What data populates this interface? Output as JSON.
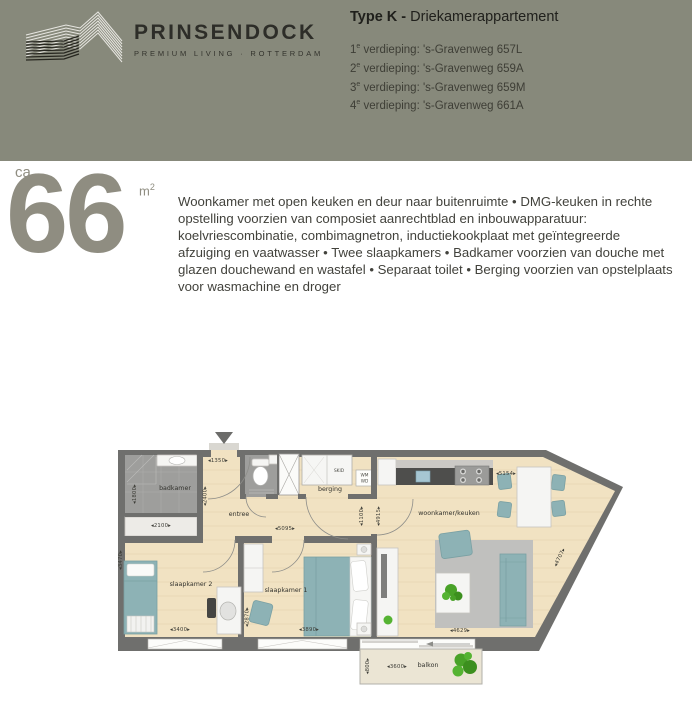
{
  "brand": {
    "name": "PRINSENDOCK",
    "tagline": "PREMIUM LIVING · ROTTERDAM"
  },
  "header": {
    "type_bold": "Type K -",
    "type_rest": " Driekamerappartement",
    "floors": [
      {
        "num": "1",
        "sup": "e",
        "rest": " verdieping: 's-Gravenweg 657L"
      },
      {
        "num": "2",
        "sup": "e",
        "rest": " verdieping: 's-Gravenweg 659A"
      },
      {
        "num": "3",
        "sup": "e",
        "rest": " verdieping: 's-Gravenweg 659M"
      },
      {
        "num": "4",
        "sup": "e",
        "rest": " verdieping: 's-Gravenweg 661A"
      }
    ]
  },
  "area": {
    "prefix": "ca.",
    "value": "66",
    "unit": "m",
    "unit_sup": "2"
  },
  "description": "Woonkamer met open keuken en deur naar buitenruimte  •  DMG-keuken in rechte opstelling voorzien van composiet aanrechtblad en inbouwapparatuur: koelvriescombinatie, combimagnetron, inductiekookplaat met geïntegreerde afzuiging en vaatwasser  •  Twee slaapkamers  •  Badkamer voorzien van douche met glazen douchewand en wastafel  •  Separaat toilet  •  Berging voorzien van opstelplaats voor wasmachine en droger",
  "colors": {
    "header_bg": "#87897b",
    "accent": "#8f8d81",
    "wall": "#6f6f6d",
    "floor_wood": "#f1e2c2",
    "floor_tile": "#9e9e9c",
    "furniture_teal": "#8db2b5",
    "plant_green": "#4aa32a"
  },
  "plan": {
    "rooms": {
      "badkamer": "badkamer",
      "berging": "berging",
      "entree": "entree",
      "woonkamer": "woonkamer/keuken",
      "slaapkamer1": "slaapkamer 1",
      "slaapkamer2": "slaapkamer 2",
      "balkon": "balkon",
      "skid": "SKID",
      "wm": "WM",
      "wd": "WD"
    },
    "dims": {
      "d1350": "◂1350▸",
      "d1800": "◂1800▸",
      "d2100": "◂2100▸",
      "d2400": "◂2400▸",
      "d3470": "◂3470▸",
      "d5095": "◂5095▸",
      "d1100": "◂1100▸",
      "d4915": "◂4915▸",
      "d5154": "◂5154▸",
      "d4707": "◂4707▸",
      "d4629": "◂4629▸",
      "d3400": "◂3400▸",
      "d2870": "◂2870▸",
      "d3890": "◂3890▸",
      "d3600": "◂3600▸",
      "d800": "◂800▸"
    }
  }
}
